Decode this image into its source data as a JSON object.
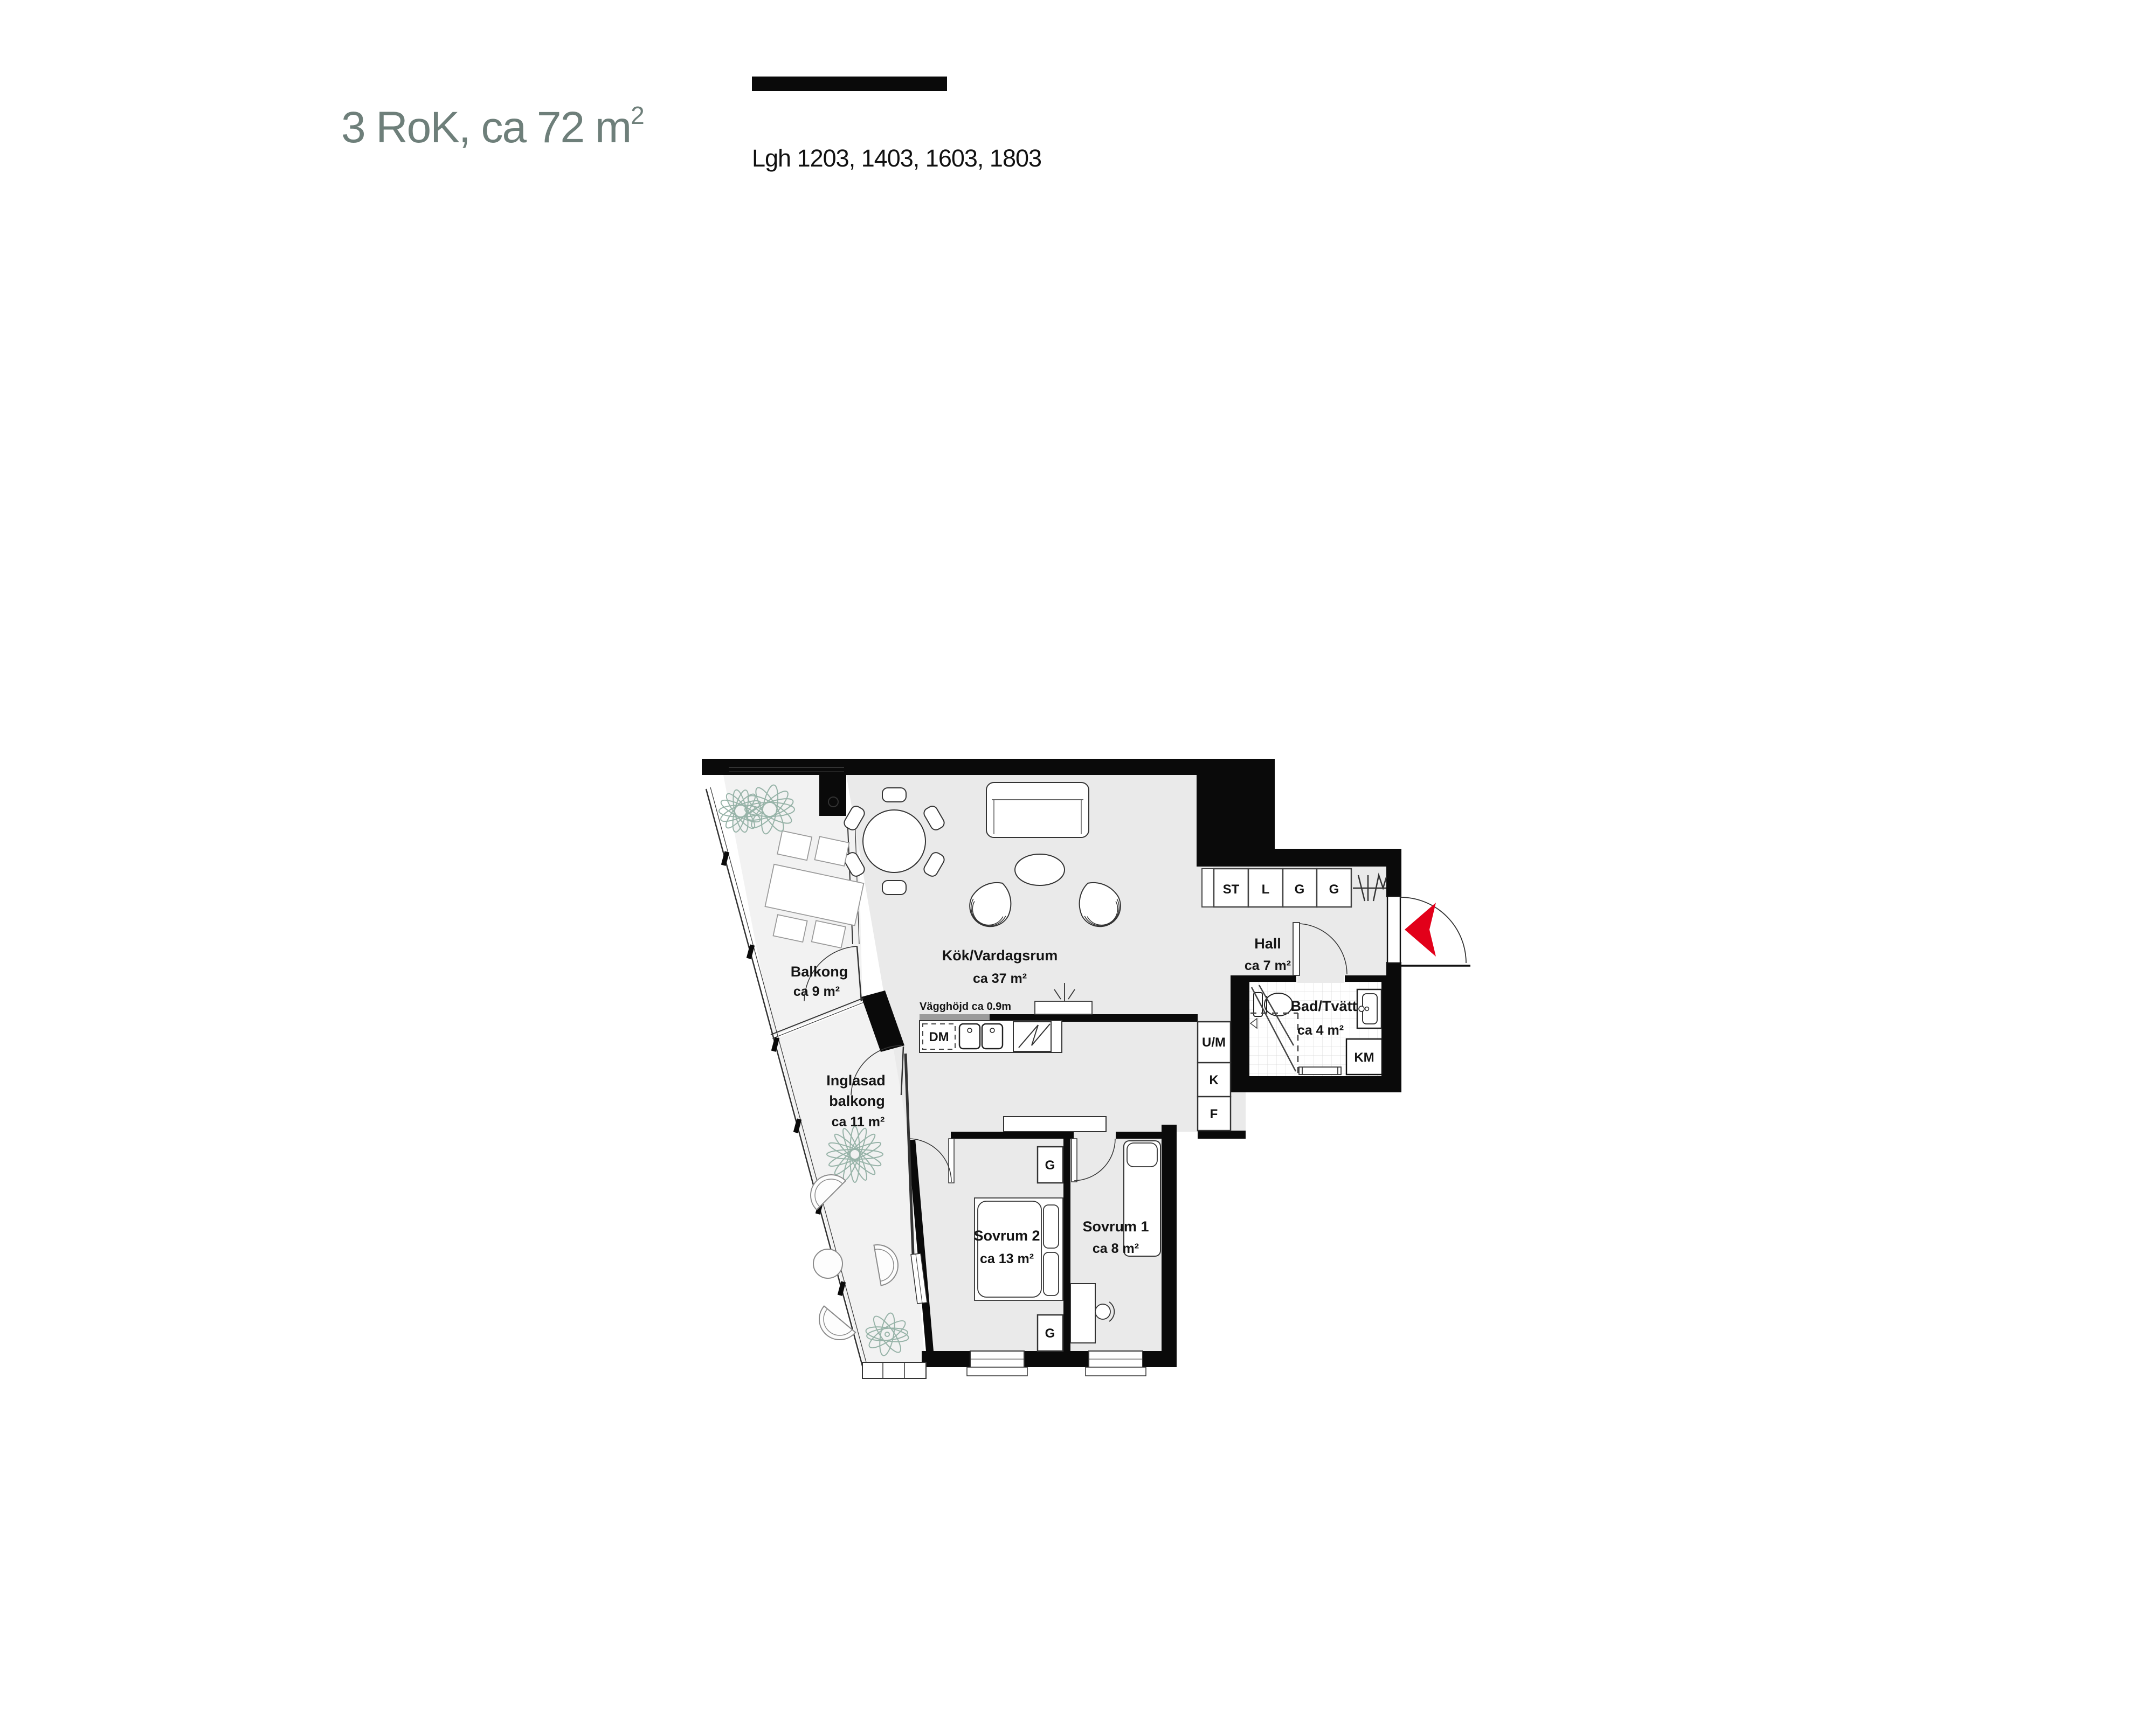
{
  "header": {
    "title_prefix": "3 RoK, ca 72 m",
    "title_sup": "2",
    "apartments": "Lgh 1203, 1403, 1603, 1803"
  },
  "colors": {
    "accent_red": "#e2001a",
    "title_green": "#6e7f7a",
    "floor_gray": "#eaeaea",
    "balcony_gray": "#f2f2f2",
    "wall_black": "#0a0a0a",
    "plant_green": "#97b3a8"
  },
  "rooms": {
    "living": {
      "name": "Kök/Vardagsrum",
      "area": "ca 37 m²"
    },
    "hall": {
      "name": "Hall",
      "area": "ca 7 m²"
    },
    "bath": {
      "name": "Bad/Tvätt",
      "area": "ca 4 m²"
    },
    "bedroom2": {
      "name": "Sovrum 2",
      "area": "ca 13 m²"
    },
    "bedroom1": {
      "name": "Sovrum 1",
      "area": "ca 8 m²"
    },
    "balcony": {
      "name": "Balkong",
      "area": "ca 9 m²"
    },
    "glazed_balcony": {
      "line1": "Inglasad",
      "line2": "balkong",
      "area": "ca 11 m²"
    }
  },
  "fixtures": {
    "closets": [
      "ST",
      "L",
      "G",
      "G"
    ],
    "kitchen_column": [
      "U/M",
      "K",
      "F"
    ],
    "dishwasher": "DM",
    "washing_machine": "KM",
    "wardrobe": "G",
    "wall_height_note": "Vägghöjd ca 0.9m"
  }
}
